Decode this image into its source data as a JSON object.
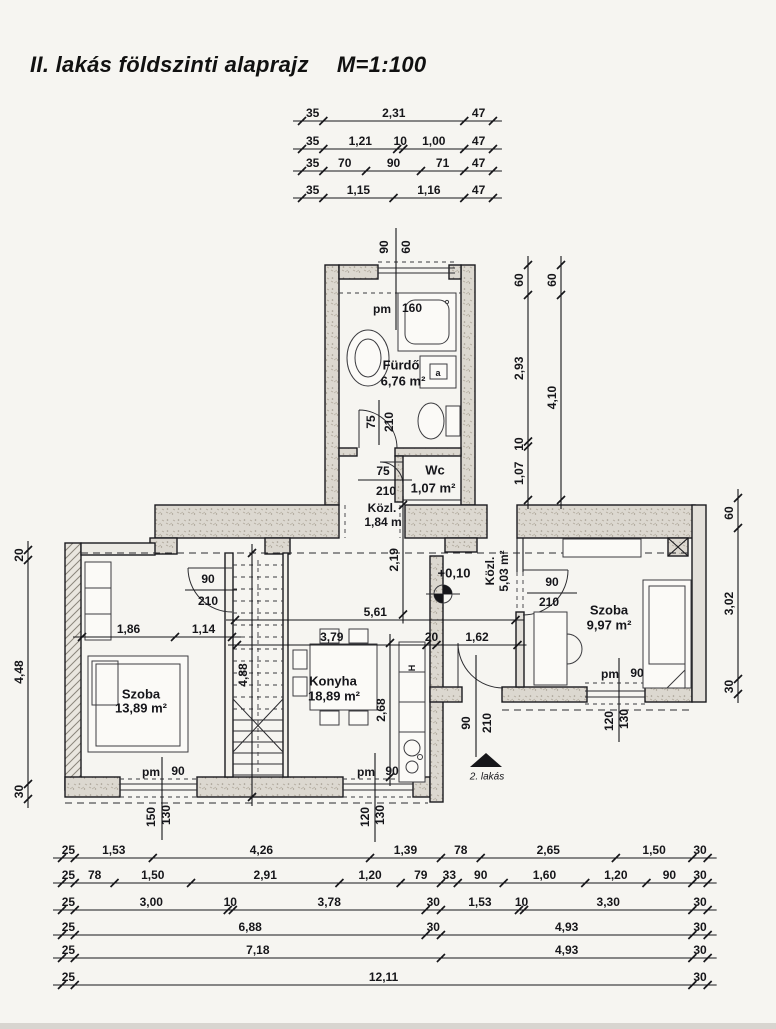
{
  "title": {
    "main": "II. lakás földszinti alaprajz",
    "scale": "M=1:100"
  },
  "rooms": {
    "furdo": {
      "name": "Fürdő",
      "area": "6,76 m²"
    },
    "wc": {
      "name": "Wc",
      "area": "1,07 m²"
    },
    "kozl1": {
      "name": "Közl.",
      "area": "1,84 m"
    },
    "kozl2": {
      "name": "Közl.",
      "area": "5,03 m²"
    },
    "szoba1": {
      "name": "Szoba",
      "area": "13,89 m²"
    },
    "konyha": {
      "name": "Konyha",
      "area": "18,89 m²"
    },
    "szoba2": {
      "name": "Szoba",
      "area": "9,97 m²"
    }
  },
  "level_mark": "+0,10",
  "entry_label": "2. lakás",
  "fixtures": {
    "a": "a",
    "h": "H"
  },
  "door_marks": {
    "hall_szoba1": {
      "width": "90",
      "height": "210"
    },
    "kozl_szoba2": {
      "width": "90",
      "height": "210"
    },
    "wc": {
      "width": "75",
      "height": "210"
    },
    "furdo": {
      "width": "75",
      "height": "210"
    },
    "entry": {
      "width": "90",
      "height": "210"
    }
  },
  "window_marks": {
    "furdo_top": {
      "prefix": "pm",
      "value": "160",
      "a": "90",
      "b": "60"
    },
    "szoba1_bottom": {
      "prefix": "pm",
      "value": "90",
      "a": "150",
      "b": "130"
    },
    "konyha_bottom": {
      "prefix": "pm",
      "value": "90",
      "a": "120",
      "b": "130"
    },
    "szoba2_bottom": {
      "prefix": "pm",
      "value": "90",
      "a": "120",
      "b": "130"
    }
  },
  "chains": {
    "top1": {
      "m": [
        0.35,
        2.31,
        0.47
      ],
      "labels": [
        "35",
        "2,31",
        "47"
      ]
    },
    "top2": {
      "m": [
        0.35,
        1.21,
        0.1,
        1.0,
        0.47
      ],
      "labels": [
        "35",
        "1,21",
        "10",
        "1,00",
        "47"
      ]
    },
    "top3": {
      "m": [
        0.35,
        0.7,
        0.9,
        0.71,
        0.47
      ],
      "labels": [
        "35",
        "70",
        "90",
        "71",
        "47"
      ]
    },
    "top4": {
      "m": [
        0.35,
        1.15,
        1.16,
        0.47
      ],
      "labels": [
        "35",
        "1,15",
        "1,16",
        "47"
      ]
    },
    "bottom1": {
      "m": [
        0.25,
        1.53,
        4.26,
        1.39,
        0.78,
        2.65,
        1.5,
        0.3
      ],
      "labels": [
        "25",
        "1,53",
        "4,26",
        "1,39",
        "78",
        "2,65",
        "1,50",
        "30"
      ]
    },
    "bottom2": {
      "m": [
        0.25,
        0.78,
        1.5,
        2.91,
        1.2,
        0.79,
        0.33,
        0.9,
        1.6,
        1.2,
        0.9,
        0.3
      ],
      "labels": [
        "25",
        "78",
        "1,50",
        "2,91",
        "1,20",
        "79",
        "33",
        "90",
        "1,60",
        "1,20",
        "90",
        "30"
      ]
    },
    "bottom3": {
      "m": [
        0.25,
        3.0,
        0.1,
        3.78,
        0.3,
        1.53,
        0.1,
        3.3,
        0.3
      ],
      "labels": [
        "25",
        "3,00",
        "10",
        "3,78",
        "30",
        "1,53",
        "10",
        "3,30",
        "30"
      ]
    },
    "bottom4": {
      "m": [
        0.25,
        6.88,
        0.3,
        4.93,
        0.3
      ],
      "labels": [
        "25",
        "6,88",
        "30",
        "4,93",
        "30"
      ]
    },
    "bottom5": {
      "m": [
        0.25,
        7.18,
        4.93,
        0.3
      ],
      "labels": [
        "25",
        "7,18",
        "4,93",
        "30"
      ]
    },
    "bottom6": {
      "m": [
        0.25,
        12.11,
        0.3
      ],
      "labels": [
        "25",
        "12,11",
        "30"
      ]
    },
    "left": {
      "m": [
        0.2,
        4.48,
        0.3
      ],
      "labels": [
        "20",
        "4,48",
        "30"
      ]
    },
    "right": {
      "m": [
        0.6,
        3.02,
        0.3
      ],
      "labels": [
        "60",
        "3,02",
        "30"
      ]
    },
    "bath_inner": {
      "m": [
        0.6,
        2.93,
        0.1,
        1.07
      ],
      "labels": [
        "60",
        "2,93",
        "10",
        "1,07"
      ]
    },
    "bath_outer": {
      "m": [
        0.6,
        4.1
      ],
      "labels": [
        "60",
        "4,10"
      ]
    },
    "hall": {
      "m": [
        1.86,
        1.14
      ],
      "labels": [
        "1,86",
        "1,14"
      ]
    },
    "mid_upper": {
      "m": [
        5.61
      ],
      "labels": [
        "5,61"
      ]
    },
    "mid_lower": {
      "m": [
        3.79,
        0.2,
        1.62
      ],
      "labels": [
        "3,79",
        "20",
        "1,62"
      ]
    },
    "v_219": {
      "m": [
        2.19
      ],
      "labels": [
        "2,19"
      ]
    },
    "v_488": {
      "m": [
        4.88
      ],
      "labels": [
        "4,88"
      ]
    },
    "v_268": {
      "m": [
        2.68
      ],
      "labels": [
        "2,68"
      ]
    }
  }
}
